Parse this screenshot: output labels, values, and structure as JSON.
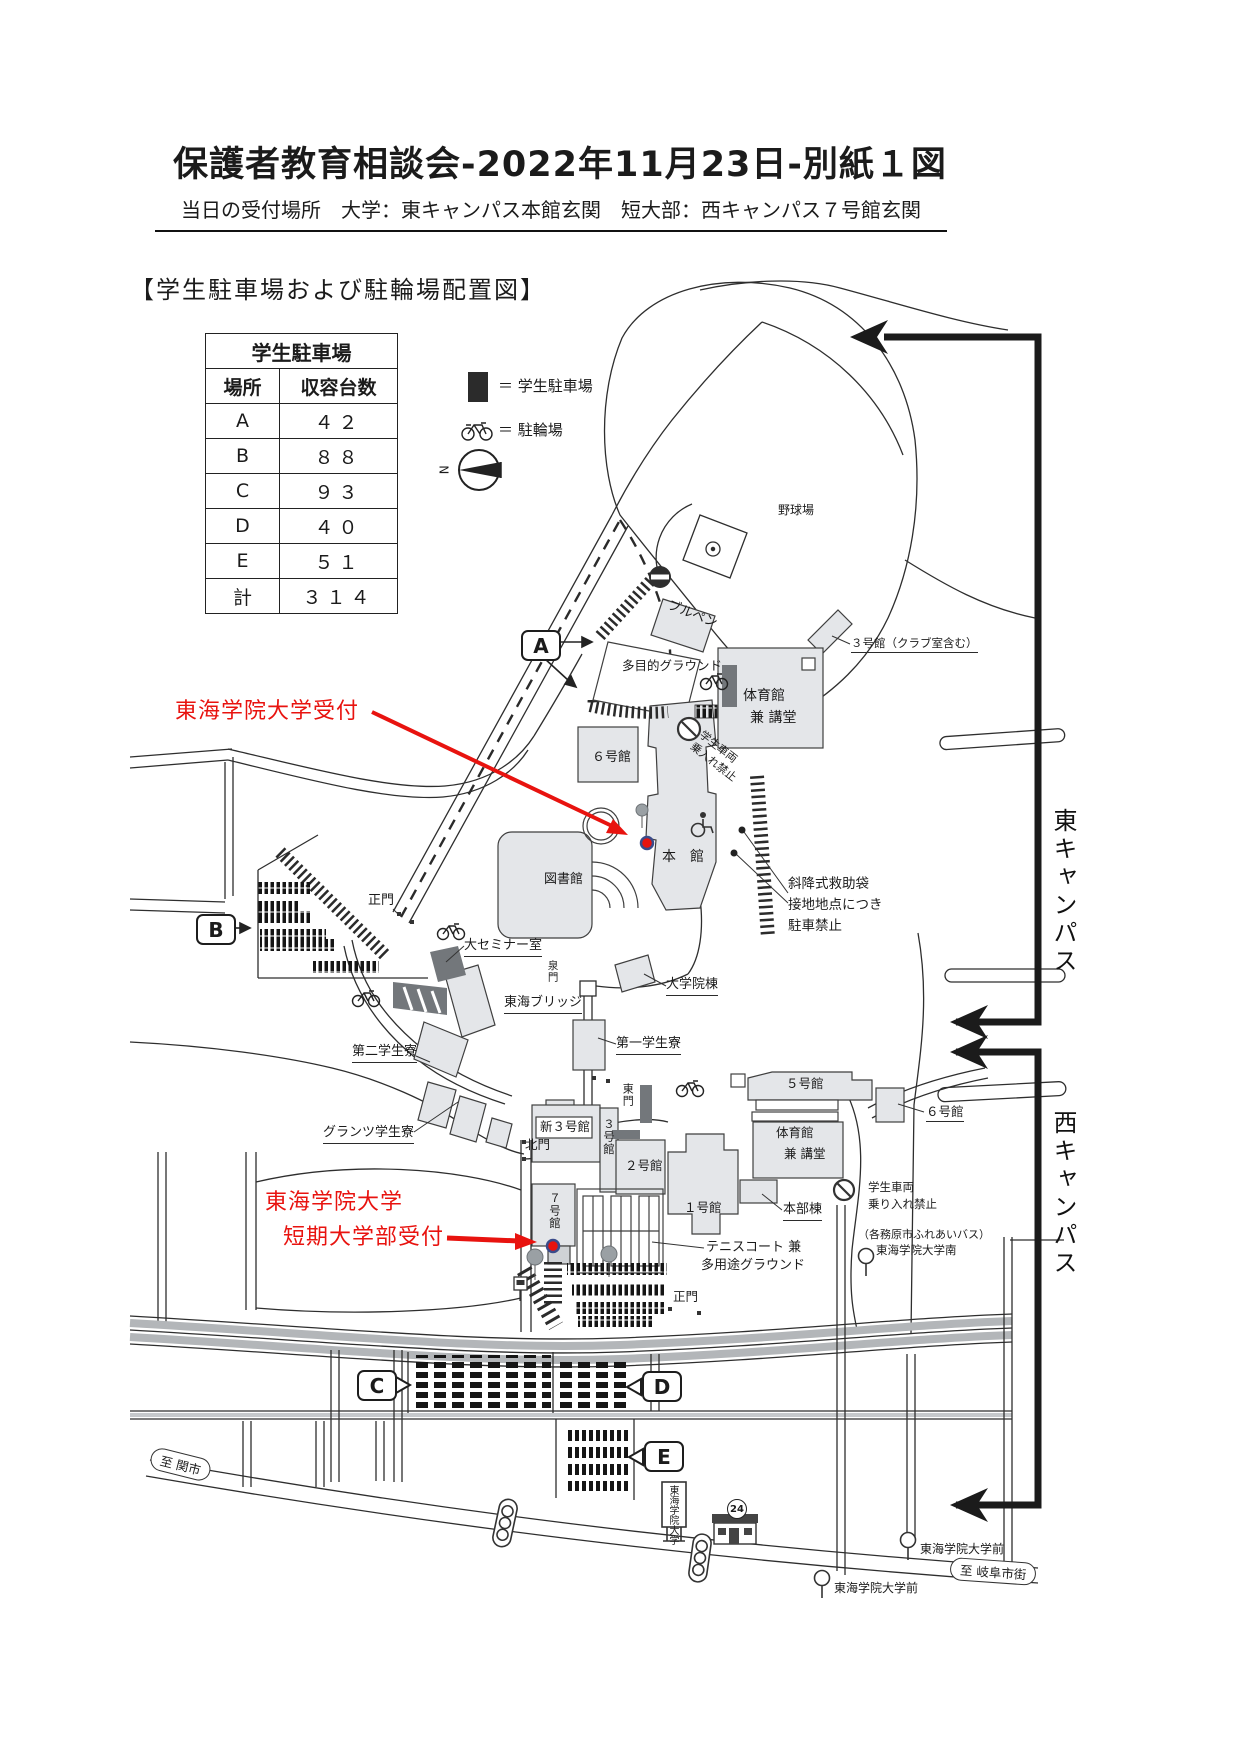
{
  "page": {
    "title": "保護者教育相談会-2022年11月23日-別紙１図",
    "subtitle": "当日の受付場所　大学：東キャンパス本館玄関　短大部：西キャンパス７号館玄関",
    "section_heading": "【学生駐車場および駐輪場配置図】"
  },
  "parking_table": {
    "title": "学生駐車場",
    "col_location": "場所",
    "col_capacity": "収容台数",
    "rows": [
      {
        "location": "A",
        "capacity": "４２"
      },
      {
        "location": "B",
        "capacity": "８８"
      },
      {
        "location": "C",
        "capacity": "９３"
      },
      {
        "location": "D",
        "capacity": "４０"
      },
      {
        "location": "E",
        "capacity": "５１"
      },
      {
        "location": "計",
        "capacity": "３１４"
      }
    ]
  },
  "legend": {
    "parking": "＝ 学生駐車場",
    "bicycle": "＝ 駐輪場",
    "north": "N"
  },
  "markers": {
    "a": "A",
    "b": "B",
    "c": "C",
    "d": "D",
    "e": "E"
  },
  "campus": {
    "east": "東キャンパス",
    "west": "西キャンパス"
  },
  "reception": {
    "univ": "東海学院大学受付",
    "jc_line1": "東海学院大学",
    "jc_line2": "短期大学部受付"
  },
  "map": {
    "baseball_field": "野球場",
    "bullpen": "ブルペン",
    "bldg3_club": "３号館（クラブ室含む）",
    "multipurpose_ground": "多目的グラウンド",
    "gym_east_1": "体育館",
    "gym_east_2": "兼 講堂",
    "bldg6_east": "６号館",
    "no_entry_east_1": "学生車両",
    "no_entry_east_2": "乗入れ禁止",
    "main_bldg": "本　館",
    "library": "図書館",
    "main_gate_east": "正門",
    "seminar_room": "大セミナー室",
    "rescue_1": "斜降式救助袋",
    "rescue_2": "接地地点につき",
    "rescue_3": "駐車禁止",
    "grad_school": "大学院棟",
    "tokai_bridge": "東海ブリッジ",
    "dorm_first": "第一学生寮",
    "dorm_second": "第二学生寮",
    "grantz_dorm": "グランツ学生寮",
    "izumi_gate": "泉門",
    "east_gate": "東門",
    "north_gate": "北門",
    "shin_bldg3": "新３号館",
    "bldg3_west": "３号館",
    "bldg2": "２号館",
    "bldg1": "１号館",
    "bldg5": "５号館",
    "bldg6_west": "６号館",
    "gym_west_1": "体育館",
    "gym_west_2": "兼 講堂",
    "hq_bldg": "本部棟",
    "bldg7": "７号館",
    "no_entry_west_1": "学生車両",
    "no_entry_west_2": "乗り入れ禁止",
    "bus_line1": "（各務原市ふれあいバス）",
    "bus_line2": "東海学院大学南",
    "tennis_1": "テニスコート 兼",
    "tennis_2": "多用途グラウンド",
    "main_gate_west": "正門",
    "to_seki": "至 関市",
    "to_gifu": "至 岐阜市街",
    "busstop_north": "東海学院大学前",
    "busstop_south": "東海学院大学前",
    "univ_sign": "東海学院大学",
    "store_24": "24"
  },
  "colors": {
    "annotation_red": "#e8130f",
    "building_fill": "#e4e6e9",
    "dark_gray": "#73777b",
    "canal_gray": "#b3b6b9",
    "line": "#2e2e2e"
  }
}
